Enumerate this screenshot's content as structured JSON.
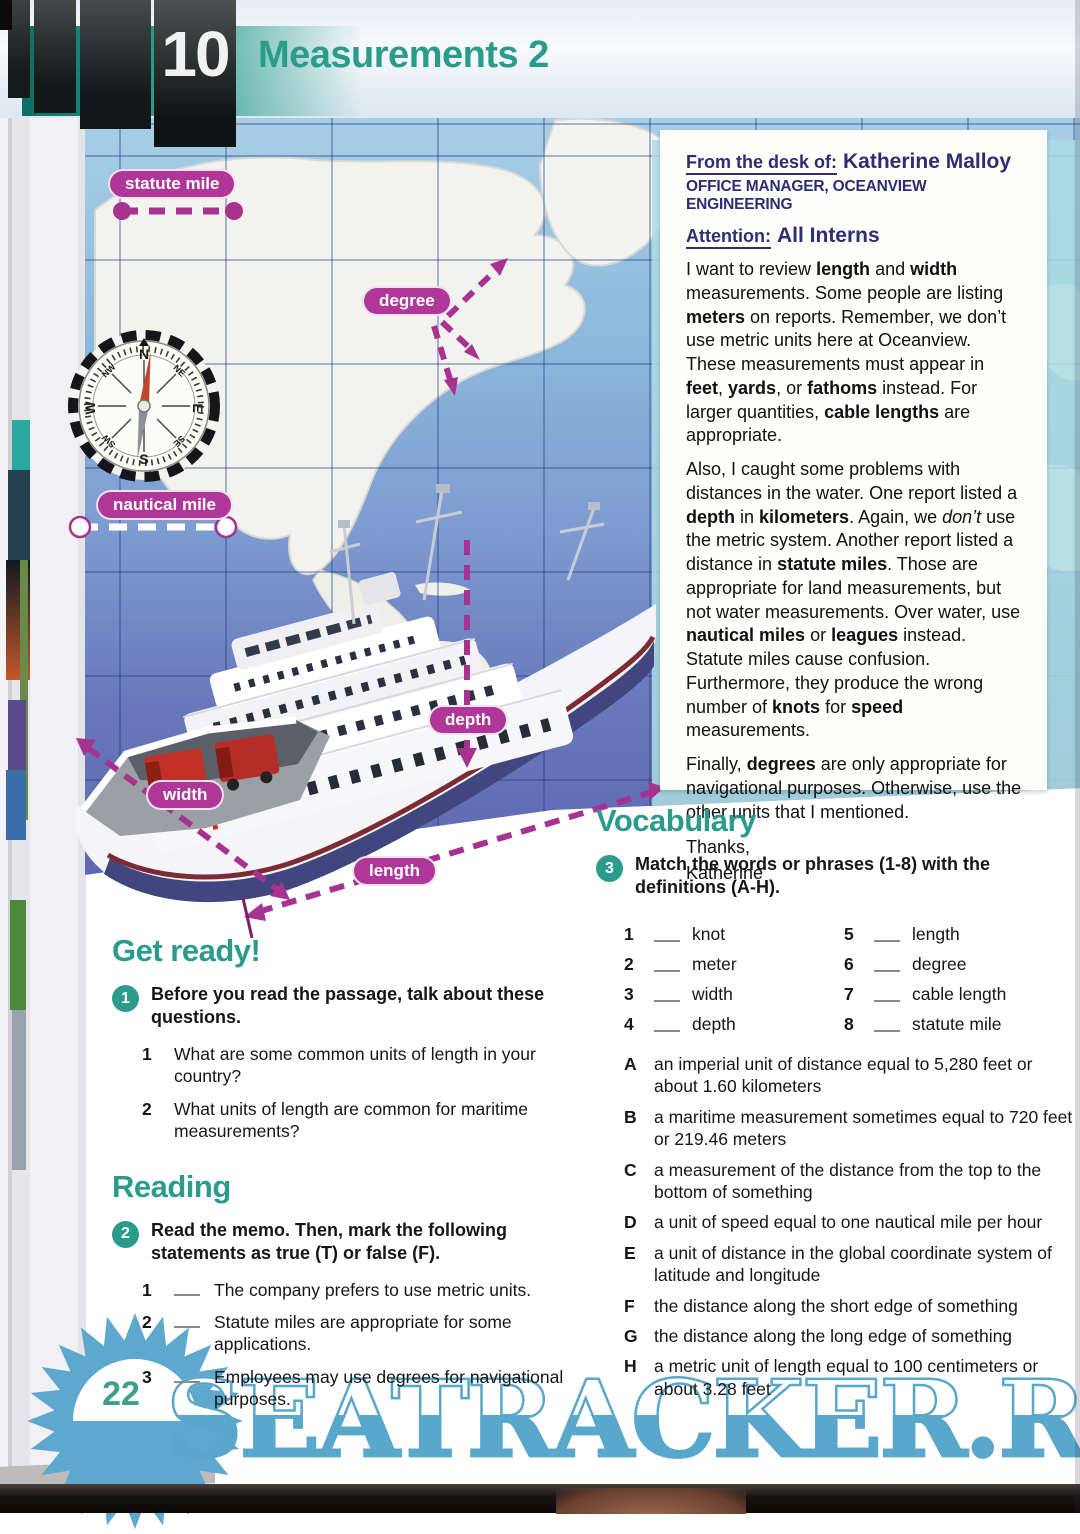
{
  "page": {
    "unit_number": "10",
    "title": "Measurements 2",
    "page_number": "22",
    "watermark": "SEATRACKER.RU"
  },
  "colors": {
    "accent_teal": "#2b9b8b",
    "pill_magenta": "#ae3798",
    "memo_navy": "#312b72",
    "watermark_blue": "#5aa7cc",
    "map_ocean_top": "#a9cfe7",
    "map_ocean_bottom": "#5e68b1"
  },
  "compass": {
    "directions": [
      "N",
      "NE",
      "E",
      "SE",
      "S",
      "SW",
      "W",
      "NW"
    ]
  },
  "diagram": {
    "labels": [
      {
        "id": "statute-mile",
        "text": "statute mile"
      },
      {
        "id": "degree",
        "text": "degree"
      },
      {
        "id": "nautical-mile",
        "text": "nautical mile"
      },
      {
        "id": "depth",
        "text": "depth"
      },
      {
        "id": "width",
        "text": "width"
      },
      {
        "id": "length",
        "text": "length"
      }
    ]
  },
  "memo": {
    "from_label": "From the desk of:",
    "from_name": "Katherine Malloy",
    "from_title": "OFFICE MANAGER, OCEANVIEW ENGINEERING",
    "attention_label": "Attention:",
    "attention_value": "All Interns",
    "paragraphs": [
      [
        {
          "t": "I want to review "
        },
        {
          "t": "length",
          "b": 1
        },
        {
          "t": " and "
        },
        {
          "t": "width",
          "b": 1
        },
        {
          "t": " measurements. Some people are listing "
        },
        {
          "t": "meters",
          "b": 1
        },
        {
          "t": " on reports. Remember, we don’t use metric units here at Oceanview. These measurements must appear in "
        },
        {
          "t": "feet",
          "b": 1
        },
        {
          "t": ", "
        },
        {
          "t": "yards",
          "b": 1
        },
        {
          "t": ", or "
        },
        {
          "t": "fathoms",
          "b": 1
        },
        {
          "t": " instead. For larger quantities, "
        },
        {
          "t": "cable lengths",
          "b": 1
        },
        {
          "t": " are appropriate."
        }
      ],
      [
        {
          "t": "Also, I caught some problems with distances in the water. One report listed a "
        },
        {
          "t": "depth",
          "b": 1
        },
        {
          "t": " in "
        },
        {
          "t": "kilometers",
          "b": 1
        },
        {
          "t": ". Again, we "
        },
        {
          "t": "don’t",
          "i": 1
        },
        {
          "t": " use the metric system. Another report listed a distance in "
        },
        {
          "t": "statute miles",
          "b": 1
        },
        {
          "t": ". Those are appropriate for land measurements, but not water measurements. Over water, use "
        },
        {
          "t": "nautical miles",
          "b": 1
        },
        {
          "t": " or "
        },
        {
          "t": "leagues",
          "b": 1
        },
        {
          "t": " instead. Statute miles cause confusion. Furthermore, they produce the wrong number of "
        },
        {
          "t": "knots",
          "b": 1
        },
        {
          "t": " for "
        },
        {
          "t": "speed",
          "b": 1
        },
        {
          "t": " measurements."
        }
      ],
      [
        {
          "t": "Finally, "
        },
        {
          "t": "degrees",
          "b": 1
        },
        {
          "t": " are only appropriate for navigational purposes. Otherwise, use the other units that I mentioned."
        }
      ]
    ],
    "closing": "Thanks,",
    "signature": "Katherine"
  },
  "sections": {
    "get_ready": {
      "heading": "Get ready!",
      "task_number": "1",
      "instruction": "Before you read the passage, talk about these questions.",
      "questions": [
        {
          "num": "1",
          "text": "What are some common units of length in your country?"
        },
        {
          "num": "2",
          "text": "What units of length are common for maritime measurements?"
        }
      ]
    },
    "reading": {
      "heading": "Reading",
      "task_number": "2",
      "instruction": "Read the memo. Then, mark the following statements as true (T) or false (F).",
      "statements": [
        {
          "num": "1",
          "text": "The company prefers to use metric units."
        },
        {
          "num": "2",
          "text": "Statute miles are appropriate for some applications."
        },
        {
          "num": "3",
          "text": "Employees may use degrees for navigational purposes."
        }
      ]
    },
    "vocabulary": {
      "heading": "Vocabulary",
      "task_number": "3",
      "instruction": "Match the words or phrases (1-8) with the definitions (A-H).",
      "terms": [
        {
          "num": "1",
          "word": "knot"
        },
        {
          "num": "2",
          "word": "meter"
        },
        {
          "num": "3",
          "word": "width"
        },
        {
          "num": "4",
          "word": "depth"
        },
        {
          "num": "5",
          "word": "length"
        },
        {
          "num": "6",
          "word": "degree"
        },
        {
          "num": "7",
          "word": "cable length"
        },
        {
          "num": "8",
          "word": "statute mile"
        }
      ],
      "definitions": [
        {
          "letter": "A",
          "text": "an imperial unit of distance equal to 5,280 feet or about 1.60 kilometers"
        },
        {
          "letter": "B",
          "text": "a maritime measurement sometimes equal to 720 feet or 219.46 meters"
        },
        {
          "letter": "C",
          "text": "a measurement of the distance from the top to the bottom of something"
        },
        {
          "letter": "D",
          "text": "a unit of speed equal to one nautical mile per hour"
        },
        {
          "letter": "E",
          "text": "a unit of distance in the global coordinate system of latitude and longitude"
        },
        {
          "letter": "F",
          "text": "the distance along the short edge of something"
        },
        {
          "letter": "G",
          "text": "the distance along the long edge of something"
        },
        {
          "letter": "H",
          "text": "a metric unit of length equal to 100 centimeters or about 3.28 feet"
        }
      ]
    }
  }
}
